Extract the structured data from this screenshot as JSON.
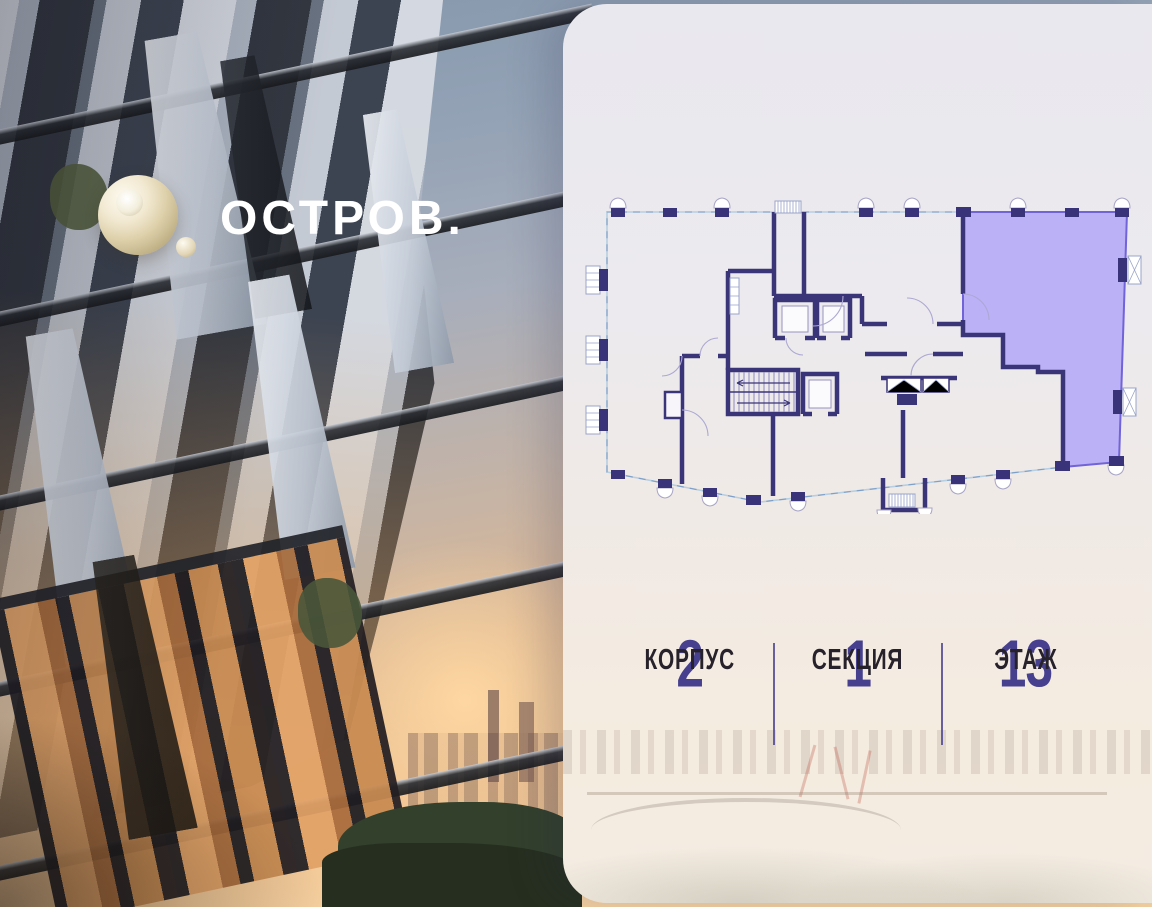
{
  "brand": {
    "logo_text": "ОСТРОВ."
  },
  "stats": {
    "items": [
      {
        "value": "2",
        "label": "КОРПУС"
      },
      {
        "value": "1",
        "label": "СЕКЦИЯ"
      },
      {
        "value": "13",
        "label": "ЭТАЖ"
      }
    ]
  },
  "plan": {
    "description": "floor-plan-with-highlighted-unit",
    "highlighted_unit_color": "#B1A7F8",
    "wall_color": "#3A3478",
    "facade_line_color": "#A9C5DC"
  },
  "colors": {
    "accent_purple": "#7163D8",
    "stat_number": "#46408E",
    "stat_label": "#26212A",
    "divider": "#4F4693",
    "logo_cream": "#EDE2C8",
    "card_background_top": "#E9E8EE",
    "card_background_bottom": "#F4ECE2"
  }
}
